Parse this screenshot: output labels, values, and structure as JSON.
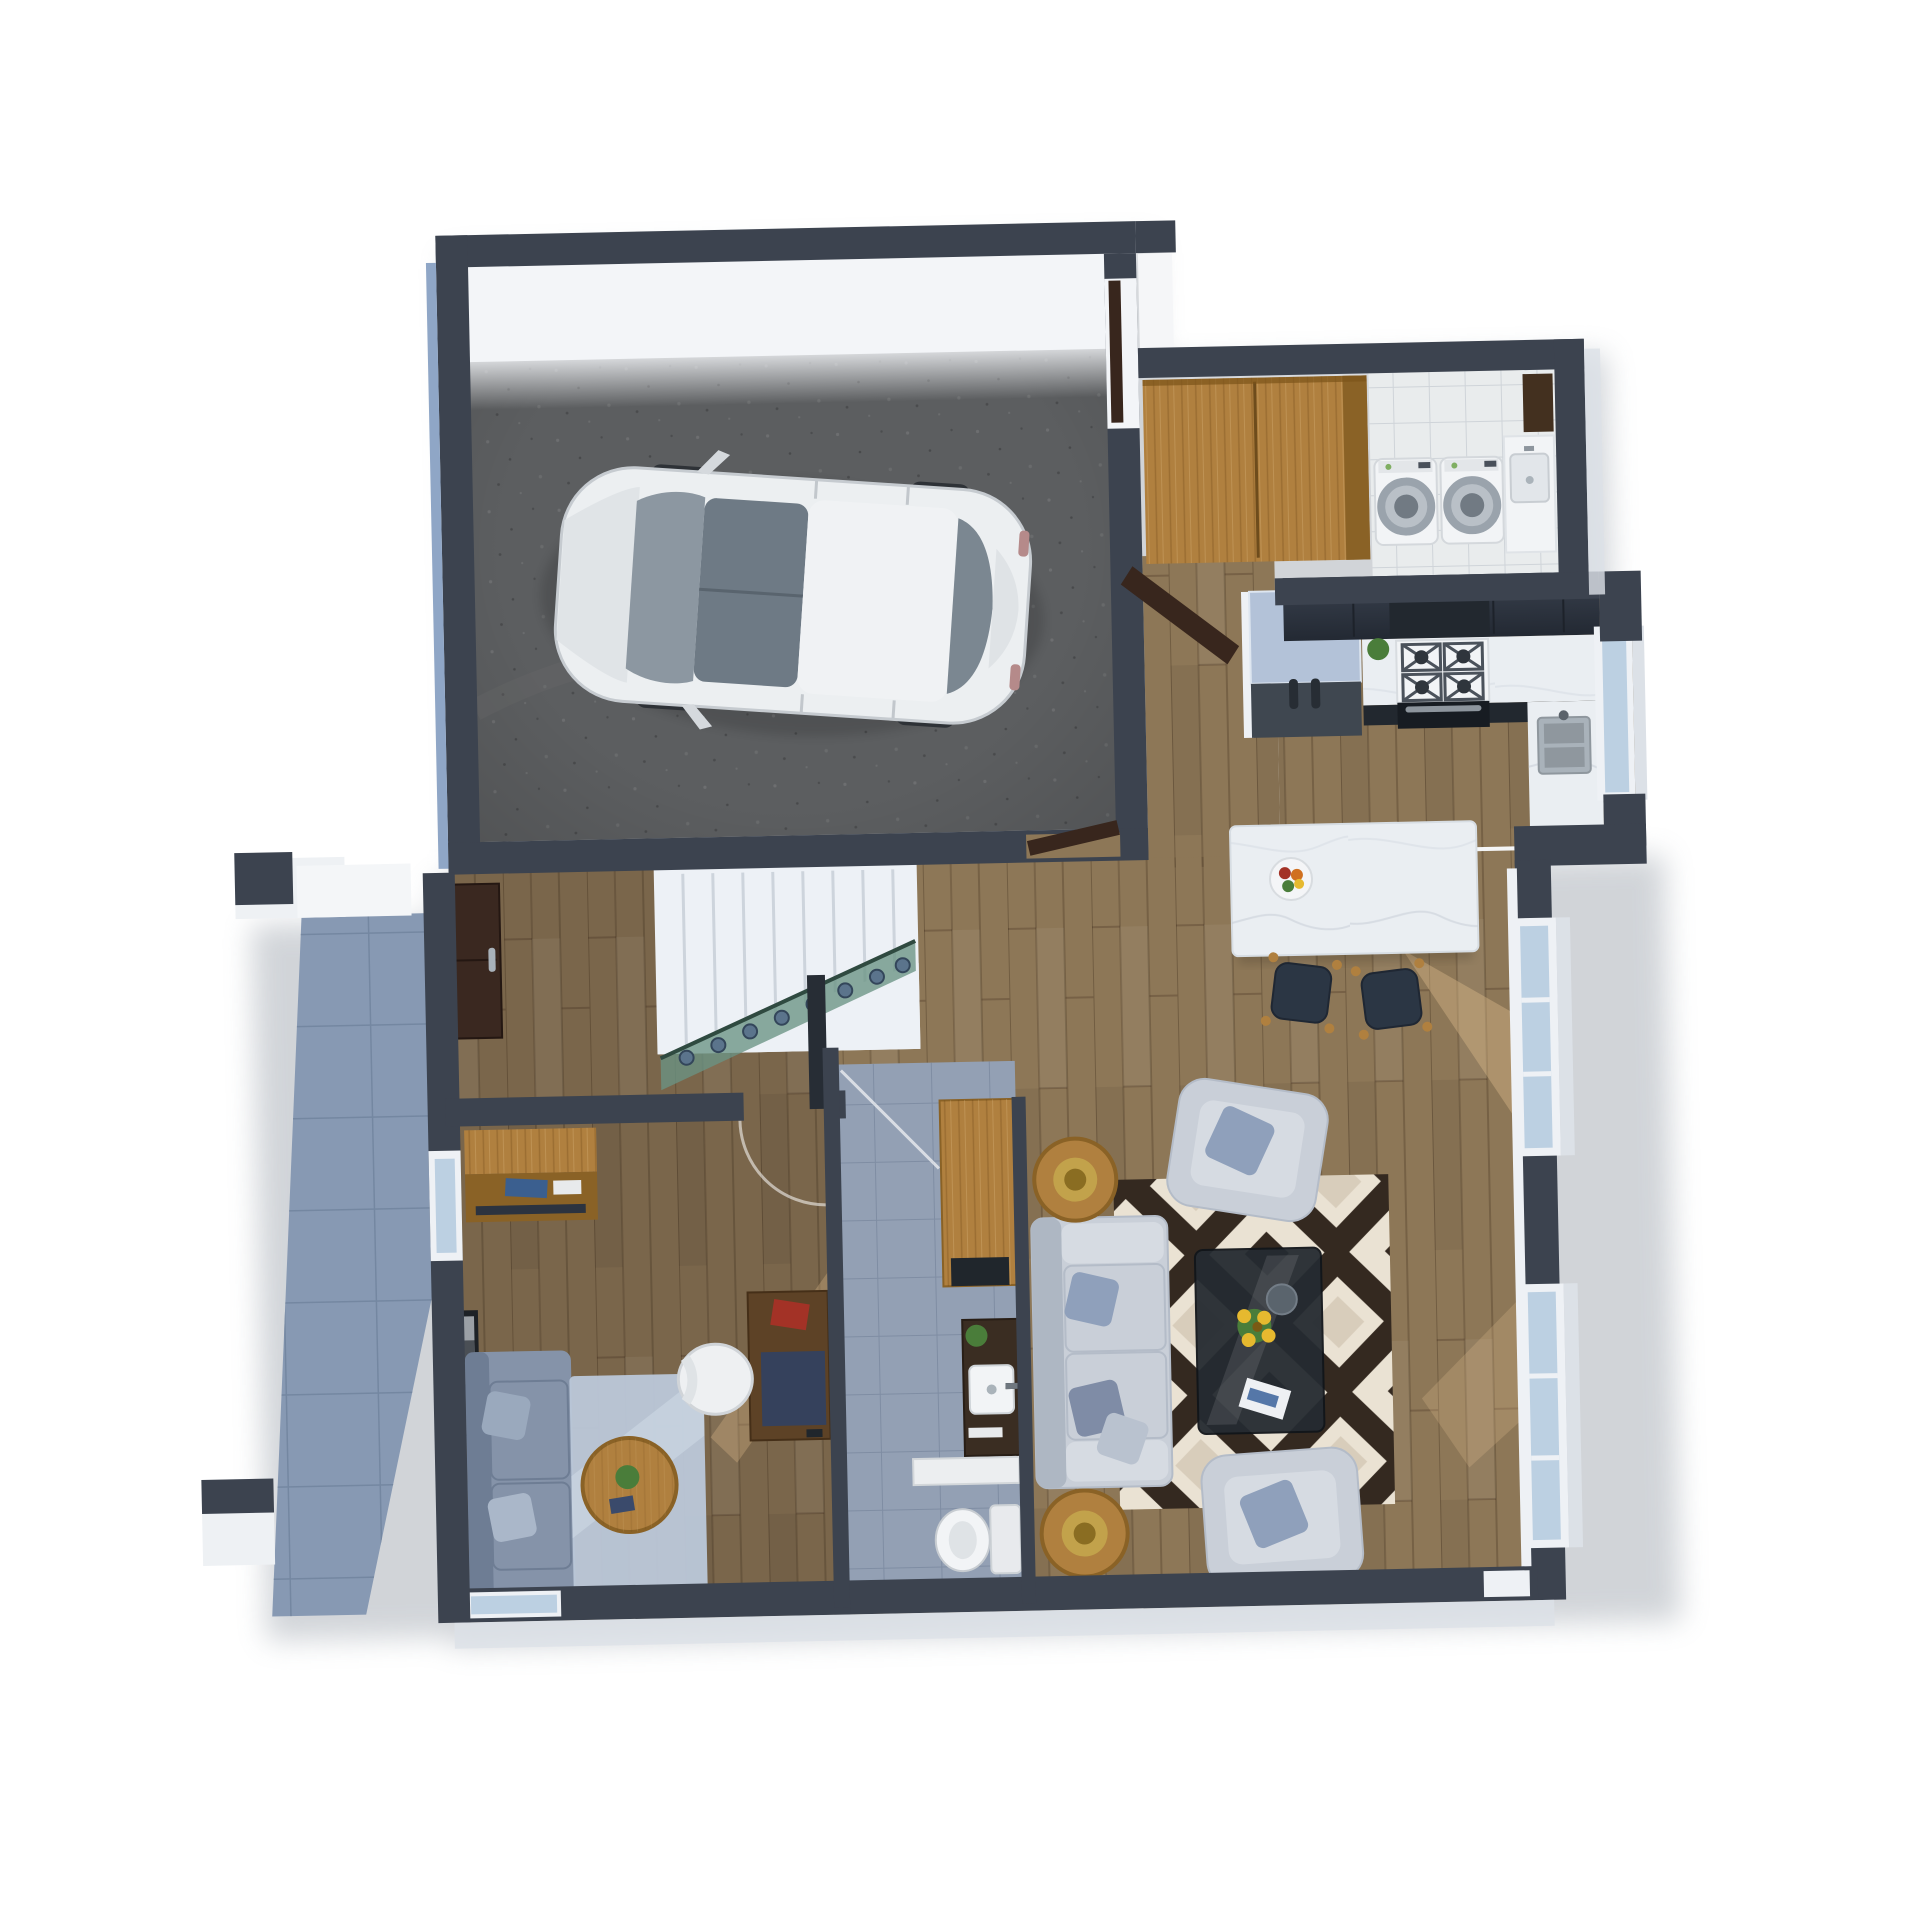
{
  "scene": {
    "title": "3D floor plan render – ground floor",
    "description": "Top-down 3D architectural visualization: attached garage with white car, mudroom/laundry, open-plan kitchen with island, stair hall with glass balustrade, study, bathroom, living room and side patio",
    "background": "#ffffff"
  },
  "palette": {
    "wall": "#3c434f",
    "wallTop": "#4a525f",
    "wallInner": "#eef1f5",
    "extBand": "#dce1e7",
    "blueEdge": "#8fa6c6",
    "concrete": "#5c5e60",
    "concreteDark": "#4e5052",
    "garageDoor": "#f3f5f8",
    "wood": "#8d7757",
    "woodDark": "#7a664b",
    "woodStreak": "#e3c08e",
    "furnWood": "#b0803f",
    "furnWoodDark": "#8a6226",
    "cabinet": "#2c333f",
    "cabinetDark": "#22282f",
    "doorBrown": "#38261d",
    "marble": "#eaeef2",
    "tileWhite": "#e9eced",
    "tileGray": "#93a0b4",
    "patio": "#8799b3",
    "applianceWhite": "#f2f4f6",
    "fridgeTop": "#b3c2d8",
    "fridgeFront": "#3f4750",
    "glassBlue": "#bcd0e2",
    "glassGreen": "#6a9484",
    "stair": "#edf1f6",
    "sofaLight": "#c9cfd8",
    "sofaShadow": "#aeb7c3",
    "cushionBlue": "#8fa0bb",
    "sofaOffice": "#8593a9",
    "sofaOfficeDark": "#6e7d94",
    "rugOffice": "#bac7d7",
    "rugCream": "#eae2d3",
    "rugDark": "#342920",
    "glassTable": "#252b31",
    "chairWhite": "#eef0f2",
    "gold": "#c2a24b",
    "red": "#a33226",
    "green": "#4a7d3a",
    "yellow": "#e6b92f",
    "steel": "#a9b2ba",
    "shadow": "#9aa1aa"
  },
  "rooms": [
    {
      "id": "garage",
      "label": "Garage",
      "floor": "concrete",
      "items": [
        "white hatchback car",
        "open garage door",
        "front entry door",
        "side door to hall"
      ]
    },
    {
      "id": "mudroom-laundry",
      "label": "Mudroom / Laundry",
      "floor": "white tile",
      "items": [
        "wood wardrobe",
        "washer",
        "dryer",
        "utility sink counter",
        "tall dark cabinet"
      ]
    },
    {
      "id": "kitchen",
      "label": "Kitchen",
      "floor": "wood plank",
      "items": [
        "refrigerator",
        "dark wall cabinets",
        "gas cooktop",
        "oven",
        "stainless sink",
        "window",
        "marble island",
        "fruit bowl",
        "2 bar stools"
      ]
    },
    {
      "id": "stair-hall",
      "label": "Hall / Staircase",
      "floor": "wood plank",
      "items": [
        "white staircase",
        "green glass balustrade",
        "newel post",
        "dark sideboard"
      ]
    },
    {
      "id": "study",
      "label": "Study / Sitting Room",
      "floor": "wood plank",
      "items": [
        "wall shelf with books",
        "wood desk",
        "red book",
        "desk chair",
        "blue-gray sofa",
        "light rug",
        "round coffee table with plant",
        "framed wall art",
        "window"
      ]
    },
    {
      "id": "bathroom",
      "label": "Powder Hall / Bathroom",
      "floor": "gray tile",
      "items": [
        "wood console table",
        "dark vanity with vessel sink",
        "plant",
        "white door",
        "toilet"
      ]
    },
    {
      "id": "living-room",
      "label": "Living Room",
      "floor": "wood plank",
      "items": [
        "light gray 2-seat sofa",
        "armchair north",
        "armchair south",
        "black and cream geometric rug",
        "smoked glass coffee table",
        "sunflower bouquet",
        "magazine",
        "2 round side tables with gold bowls",
        "picture windows"
      ]
    },
    {
      "id": "patio",
      "label": "Patio / Terrace",
      "floor": "blue-gray tile",
      "items": [
        "white pillar with dark cap",
        "white planter",
        "lower pillar"
      ]
    }
  ],
  "car": {
    "type": "hatchback",
    "color": "#eceff1",
    "location": "garage",
    "orientation": "front facing left"
  }
}
